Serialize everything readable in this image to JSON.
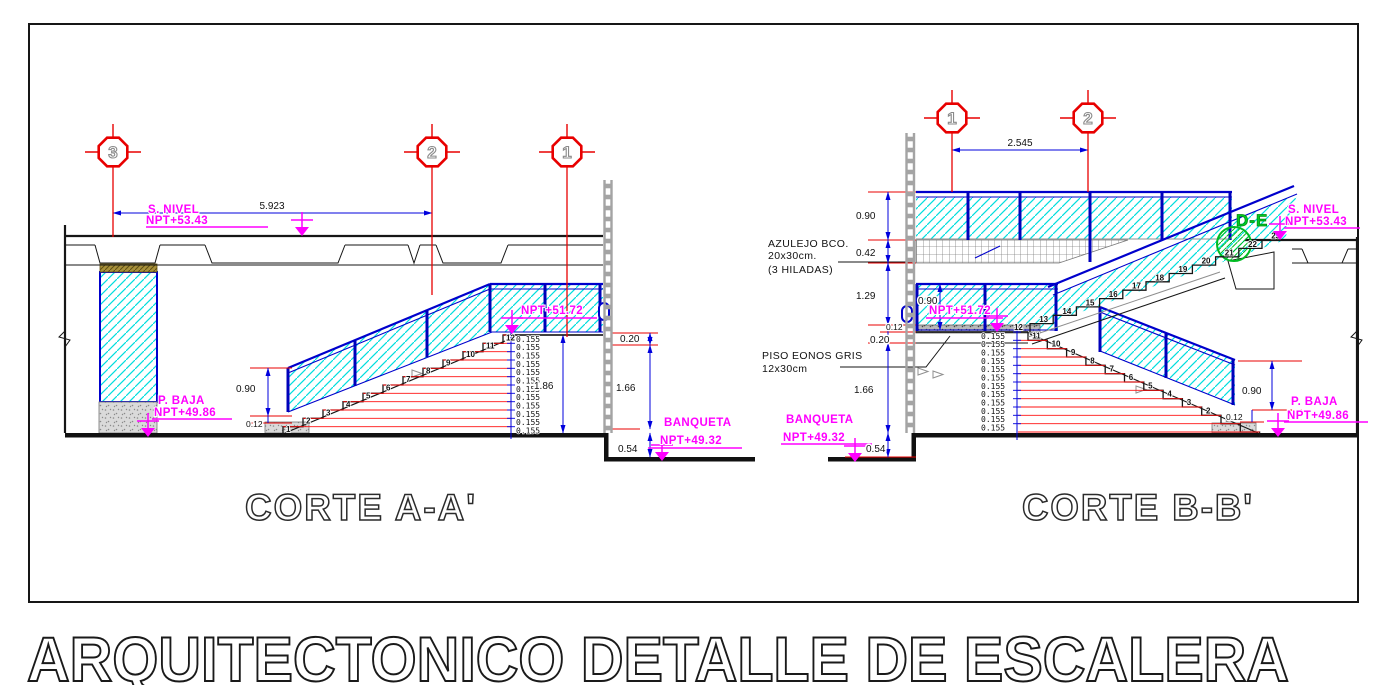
{
  "title": "ARQUITECTONICO DETALLE DE ESCALERA",
  "colors": {
    "red": "#e80000",
    "blue": "#0000cc",
    "dim_blue": "#0000dd",
    "cyan": "#00dede",
    "magenta": "#ff00ff",
    "green": "#00cc22",
    "gray": "#9a9a9a"
  },
  "corte_a": {
    "caption": "CORTE A-A'",
    "grid_bubbles": [
      "3",
      "2",
      "1"
    ],
    "dims": {
      "span": "5.923",
      "rail_height": "0.90",
      "curb": "0.12",
      "total_rise": "1.86",
      "slab_edge": "0.20",
      "storey": "1.66",
      "banqueta_drop": "0.54",
      "riser": "0.155"
    },
    "labels": {
      "s_nivel": [
        "S. NIVEL",
        "NPT+53.43"
      ],
      "mid_level": "NPT+51.72",
      "p_baja": [
        "P. BAJA",
        "NPT+49.86"
      ],
      "banqueta": [
        "BANQUETA",
        "NPT+49.32"
      ]
    },
    "step_numbers": [
      1,
      2,
      3,
      4,
      5,
      6,
      7,
      8,
      9,
      10,
      11,
      12
    ],
    "riser_count": 12
  },
  "corte_b": {
    "caption": "CORTE B-B'",
    "grid_bubbles": [
      "1",
      "2"
    ],
    "dims": {
      "span": "2.545",
      "upper_rail": "0.90",
      "tile_rows": "0.42",
      "mid_height": "1.29",
      "landing_slab": "0.12",
      "slab_edge": "0.20",
      "storey": "1.66",
      "banqueta_drop": "0.54",
      "landing_rail": "0.90",
      "lower_rail": "0.90",
      "lower_curb": "0.12",
      "riser": "0.155"
    },
    "labels": {
      "s_nivel": [
        "S. NIVEL",
        "NPT+53.43"
      ],
      "mid_level": "NPT+51.72",
      "p_baja": [
        "P. BAJA",
        "NPT+49.86"
      ],
      "banqueta": [
        "BANQUETA",
        "NPT+49.32"
      ],
      "detail_ref": "D-E"
    },
    "notes": {
      "azulejo": [
        "AZULEJO BCO.",
        "20x30cm.",
        "(3 HILADAS)"
      ],
      "piso": [
        "PISO EONOS GRIS",
        "12x30cm"
      ]
    },
    "lower_step_numbers": [
      1,
      2,
      3,
      4,
      5,
      6,
      7,
      8,
      9,
      10,
      11,
      12
    ],
    "upper_step_numbers": [
      13,
      14,
      15,
      16,
      17,
      18,
      19,
      20,
      21,
      22,
      23
    ],
    "riser_count": 12
  }
}
